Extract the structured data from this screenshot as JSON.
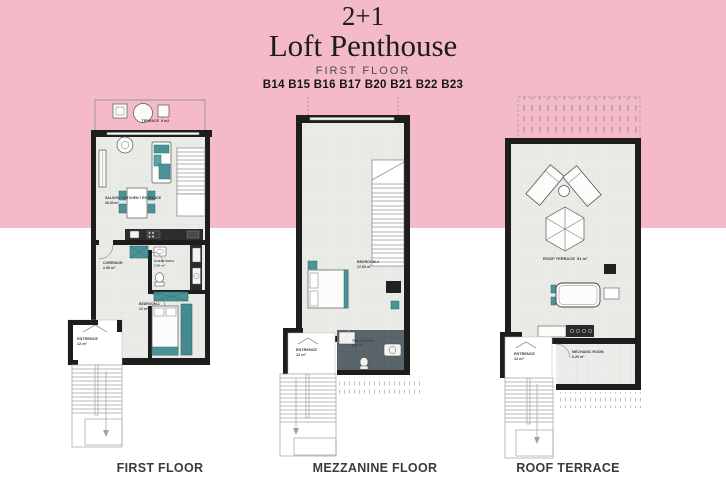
{
  "title": {
    "line1": "2+1",
    "line2": "Loft Penthouse",
    "floor_label": "FIRST FLOOR",
    "block_numbers": "B14 B15 B16 B17 B20 B21 B22 B23"
  },
  "plans": [
    {
      "caption": "FIRST FLOOR",
      "rooms": [
        {
          "name": "TERRACE",
          "area": "9 m2"
        },
        {
          "name": "SALOON + KITCHEN + ENTRANCE",
          "area": "30.30 m²"
        },
        {
          "name": "CORRIDOR",
          "area": "2.90 m²"
        },
        {
          "name": "GUEST BATH",
          "area": "3.00 m²"
        },
        {
          "name": "BEDROOM-1",
          "area": "12 m²"
        },
        {
          "name": "ENTRENCE",
          "area": "12 m²"
        }
      ]
    },
    {
      "caption": "MEZZANINE FLOOR",
      "rooms": [
        {
          "name": "BEDROOM-2",
          "area": "17.60 m²"
        },
        {
          "name": "TOILET+BATH",
          "area": "6.90 m²"
        },
        {
          "name": "ENTRENCE",
          "area": "12 m²"
        }
      ]
    },
    {
      "caption": "ROOF TERRACE",
      "rooms": [
        {
          "name": "ROOF TERRACE",
          "area": "51 m²"
        },
        {
          "name": "ENTRENCE",
          "area": "12 m²"
        },
        {
          "name": "MECHANIC ROOM",
          "area": "6.20 m²"
        }
      ]
    }
  ],
  "colors": {
    "pink": "#f4bac8",
    "wall": "#1d1d1d",
    "floor": "#eaeae7",
    "teal": "#4a9396",
    "bath_tile": "#5b666c",
    "stair": "#a2a2a2"
  }
}
